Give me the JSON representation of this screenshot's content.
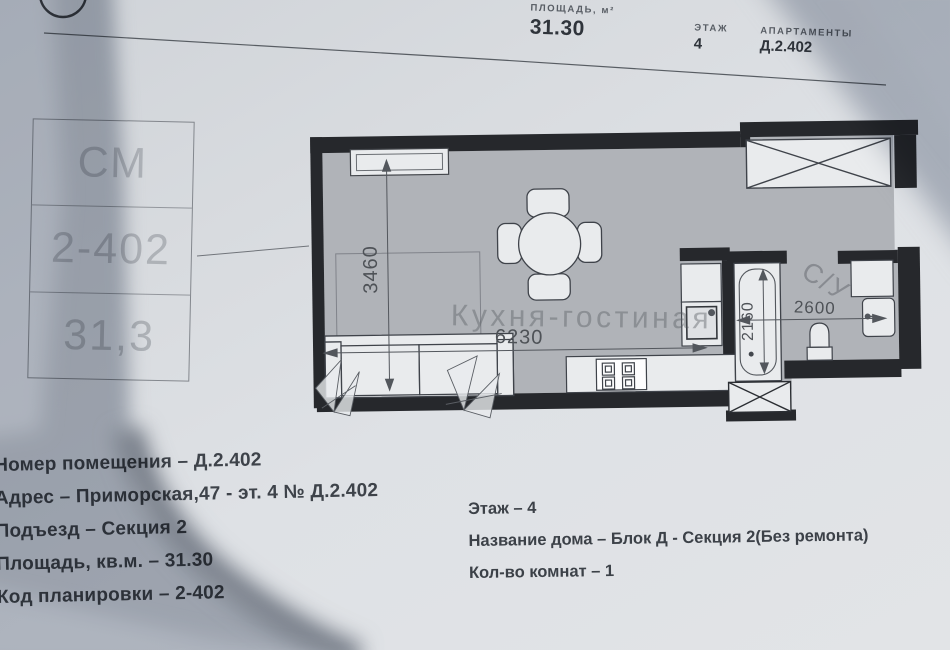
{
  "header": {
    "area_label": "ПЛОЩАДЬ, м²",
    "area_value": "31.30",
    "floor_label": "ЭТАЖ",
    "floor_value": "4",
    "apartment_label": "АПАРТАМЕНТЫ",
    "apartment_value": "Д.2.402"
  },
  "stamp_box": {
    "row1": "СМ",
    "row2": "2-402",
    "row3": "31,3"
  },
  "plan": {
    "room_label": "Кухня-гостиная",
    "bathroom_label": "С/У",
    "dimensions": {
      "room_height_mm": "3460",
      "room_width_mm": "6230",
      "bathroom_height_mm": "2160",
      "bathroom_width_mm": "2600"
    }
  },
  "details_left": {
    "lines": [
      "Номер помещения – Д.2.402",
      "Адрес – Приморская,47 - эт. 4 № Д.2.402",
      "Подъезд – Секция 2",
      "Площадь, кв.м. – 31.30",
      "Код планировки – 2-402"
    ]
  },
  "details_right": {
    "lines": [
      "Этаж – 4",
      "Название дома – Блок Д - Секция 2(Без ремонта)",
      "Кол-во комнат – 1"
    ]
  },
  "colors": {
    "paper": "#dee1e5",
    "wall": "#26282c",
    "floor": "#b0b3b8",
    "furniture": "#e9ebed",
    "ink": "#3e434a"
  }
}
